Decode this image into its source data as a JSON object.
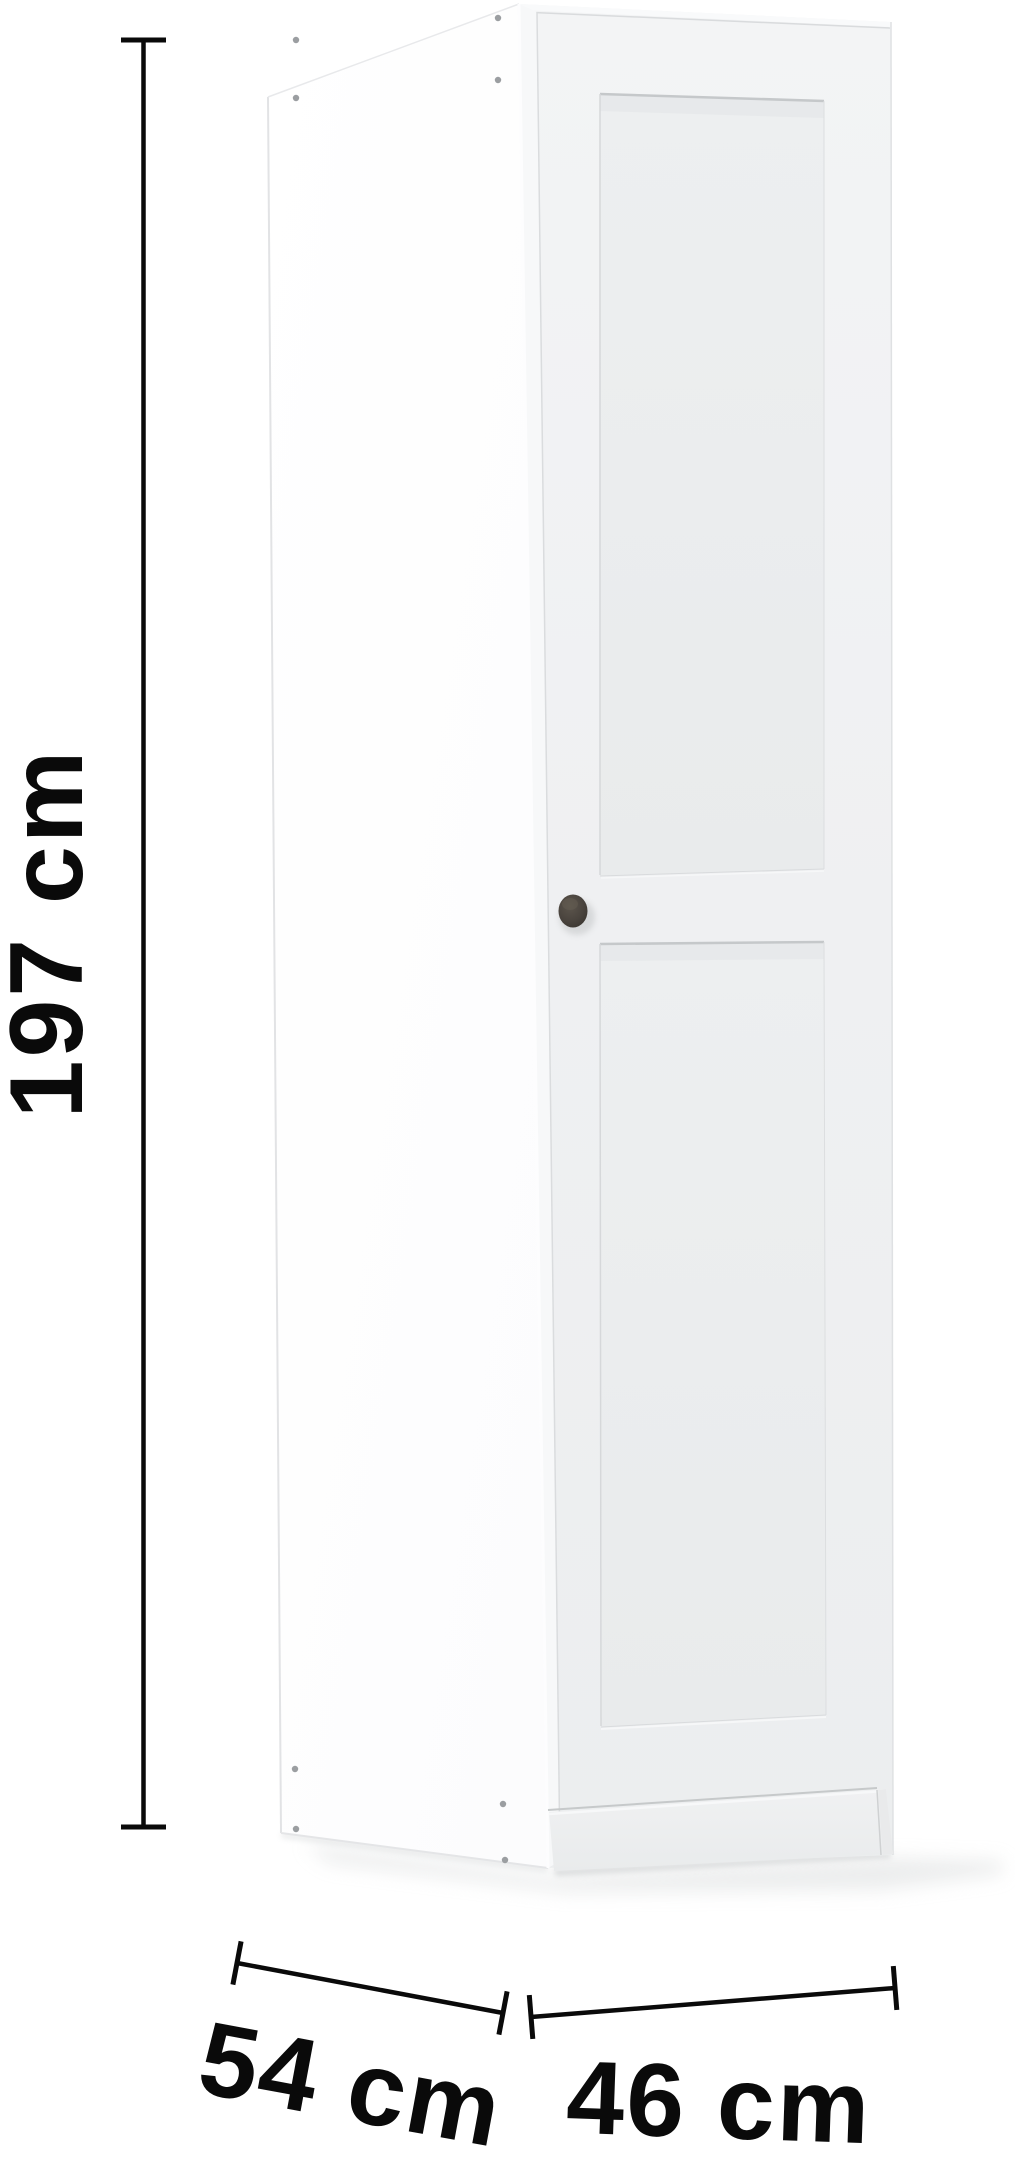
{
  "product": {
    "type": "single-door wardrobe",
    "front_color": "#f0f1f3",
    "side_color": "#ffffff",
    "knob_color": "#4a443e"
  },
  "dimensions": {
    "height": {
      "label": "197 cm"
    },
    "depth": {
      "label": "54 cm"
    },
    "width": {
      "label": "46 cm"
    }
  },
  "annotation": {
    "line_color": "#0a0a0a",
    "text_color": "#0a0a0a"
  }
}
